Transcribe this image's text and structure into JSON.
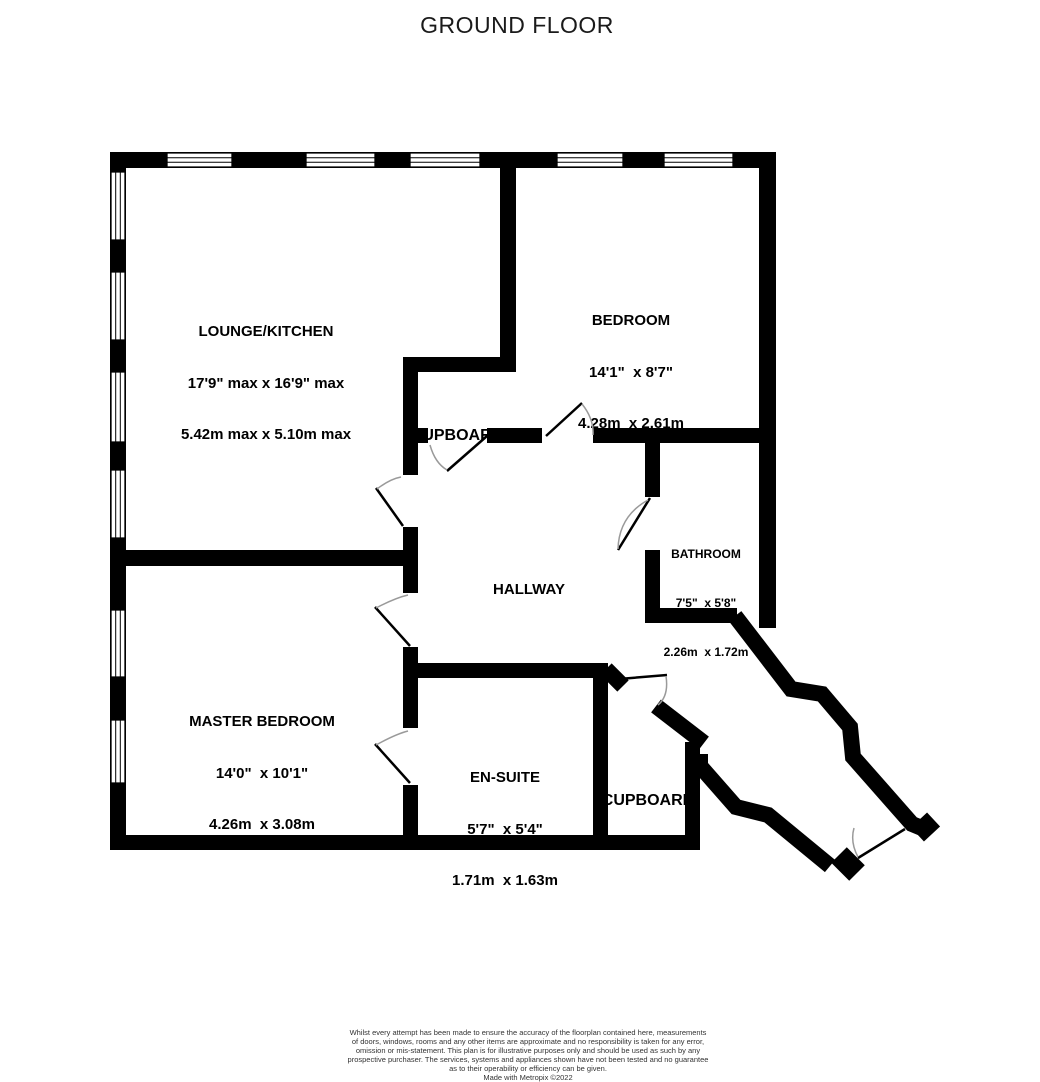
{
  "title": "GROUND FLOOR",
  "rooms": {
    "lounge_kitchen": {
      "name": "LOUNGE/KITCHEN",
      "dim_imperial": "17'9\" max x 16'9\" max",
      "dim_metric": "5.42m max x 5.10m max"
    },
    "bedroom": {
      "name": "BEDROOM",
      "dim_imperial": "14'1\"  x 8'7\"",
      "dim_metric": "4.28m  x 2.61m"
    },
    "cupboard_hall": {
      "name": "CUPBOARD"
    },
    "bathroom": {
      "name": "BATHROOM",
      "dim_imperial": "7'5\"  x 5'8\"",
      "dim_metric": "2.26m  x 1.72m"
    },
    "hallway": {
      "name": "HALLWAY"
    },
    "master_bedroom": {
      "name": "MASTER BEDROOM",
      "dim_imperial": "14'0\"  x 10'1\"",
      "dim_metric": "4.26m  x 3.08m"
    },
    "en_suite": {
      "name": "EN-SUITE",
      "dim_imperial": "5'7\"  x 5'4\"",
      "dim_metric": "1.71m  x 1.63m"
    },
    "cupboard_entrance": {
      "name": "CUPBOARD"
    }
  },
  "disclaimer": {
    "lines": [
      "Whilst every attempt has been made to ensure the accuracy of the floorplan contained here, measurements",
      "of doors, windows, rooms and any other items are approximate and no responsibility is taken for any error,",
      "omission or mis-statement. This plan is for illustrative purposes only and should be used as such by any",
      "prospective purchaser. The services, systems and appliances shown have not been tested and no guarantee",
      "as to their operability or efficiency can be given.",
      "Made with Metropix ©2022"
    ]
  },
  "colors": {
    "wall": "#000000",
    "door_arc": "#9a9a9a",
    "background": "#ffffff",
    "text": "#000000"
  }
}
